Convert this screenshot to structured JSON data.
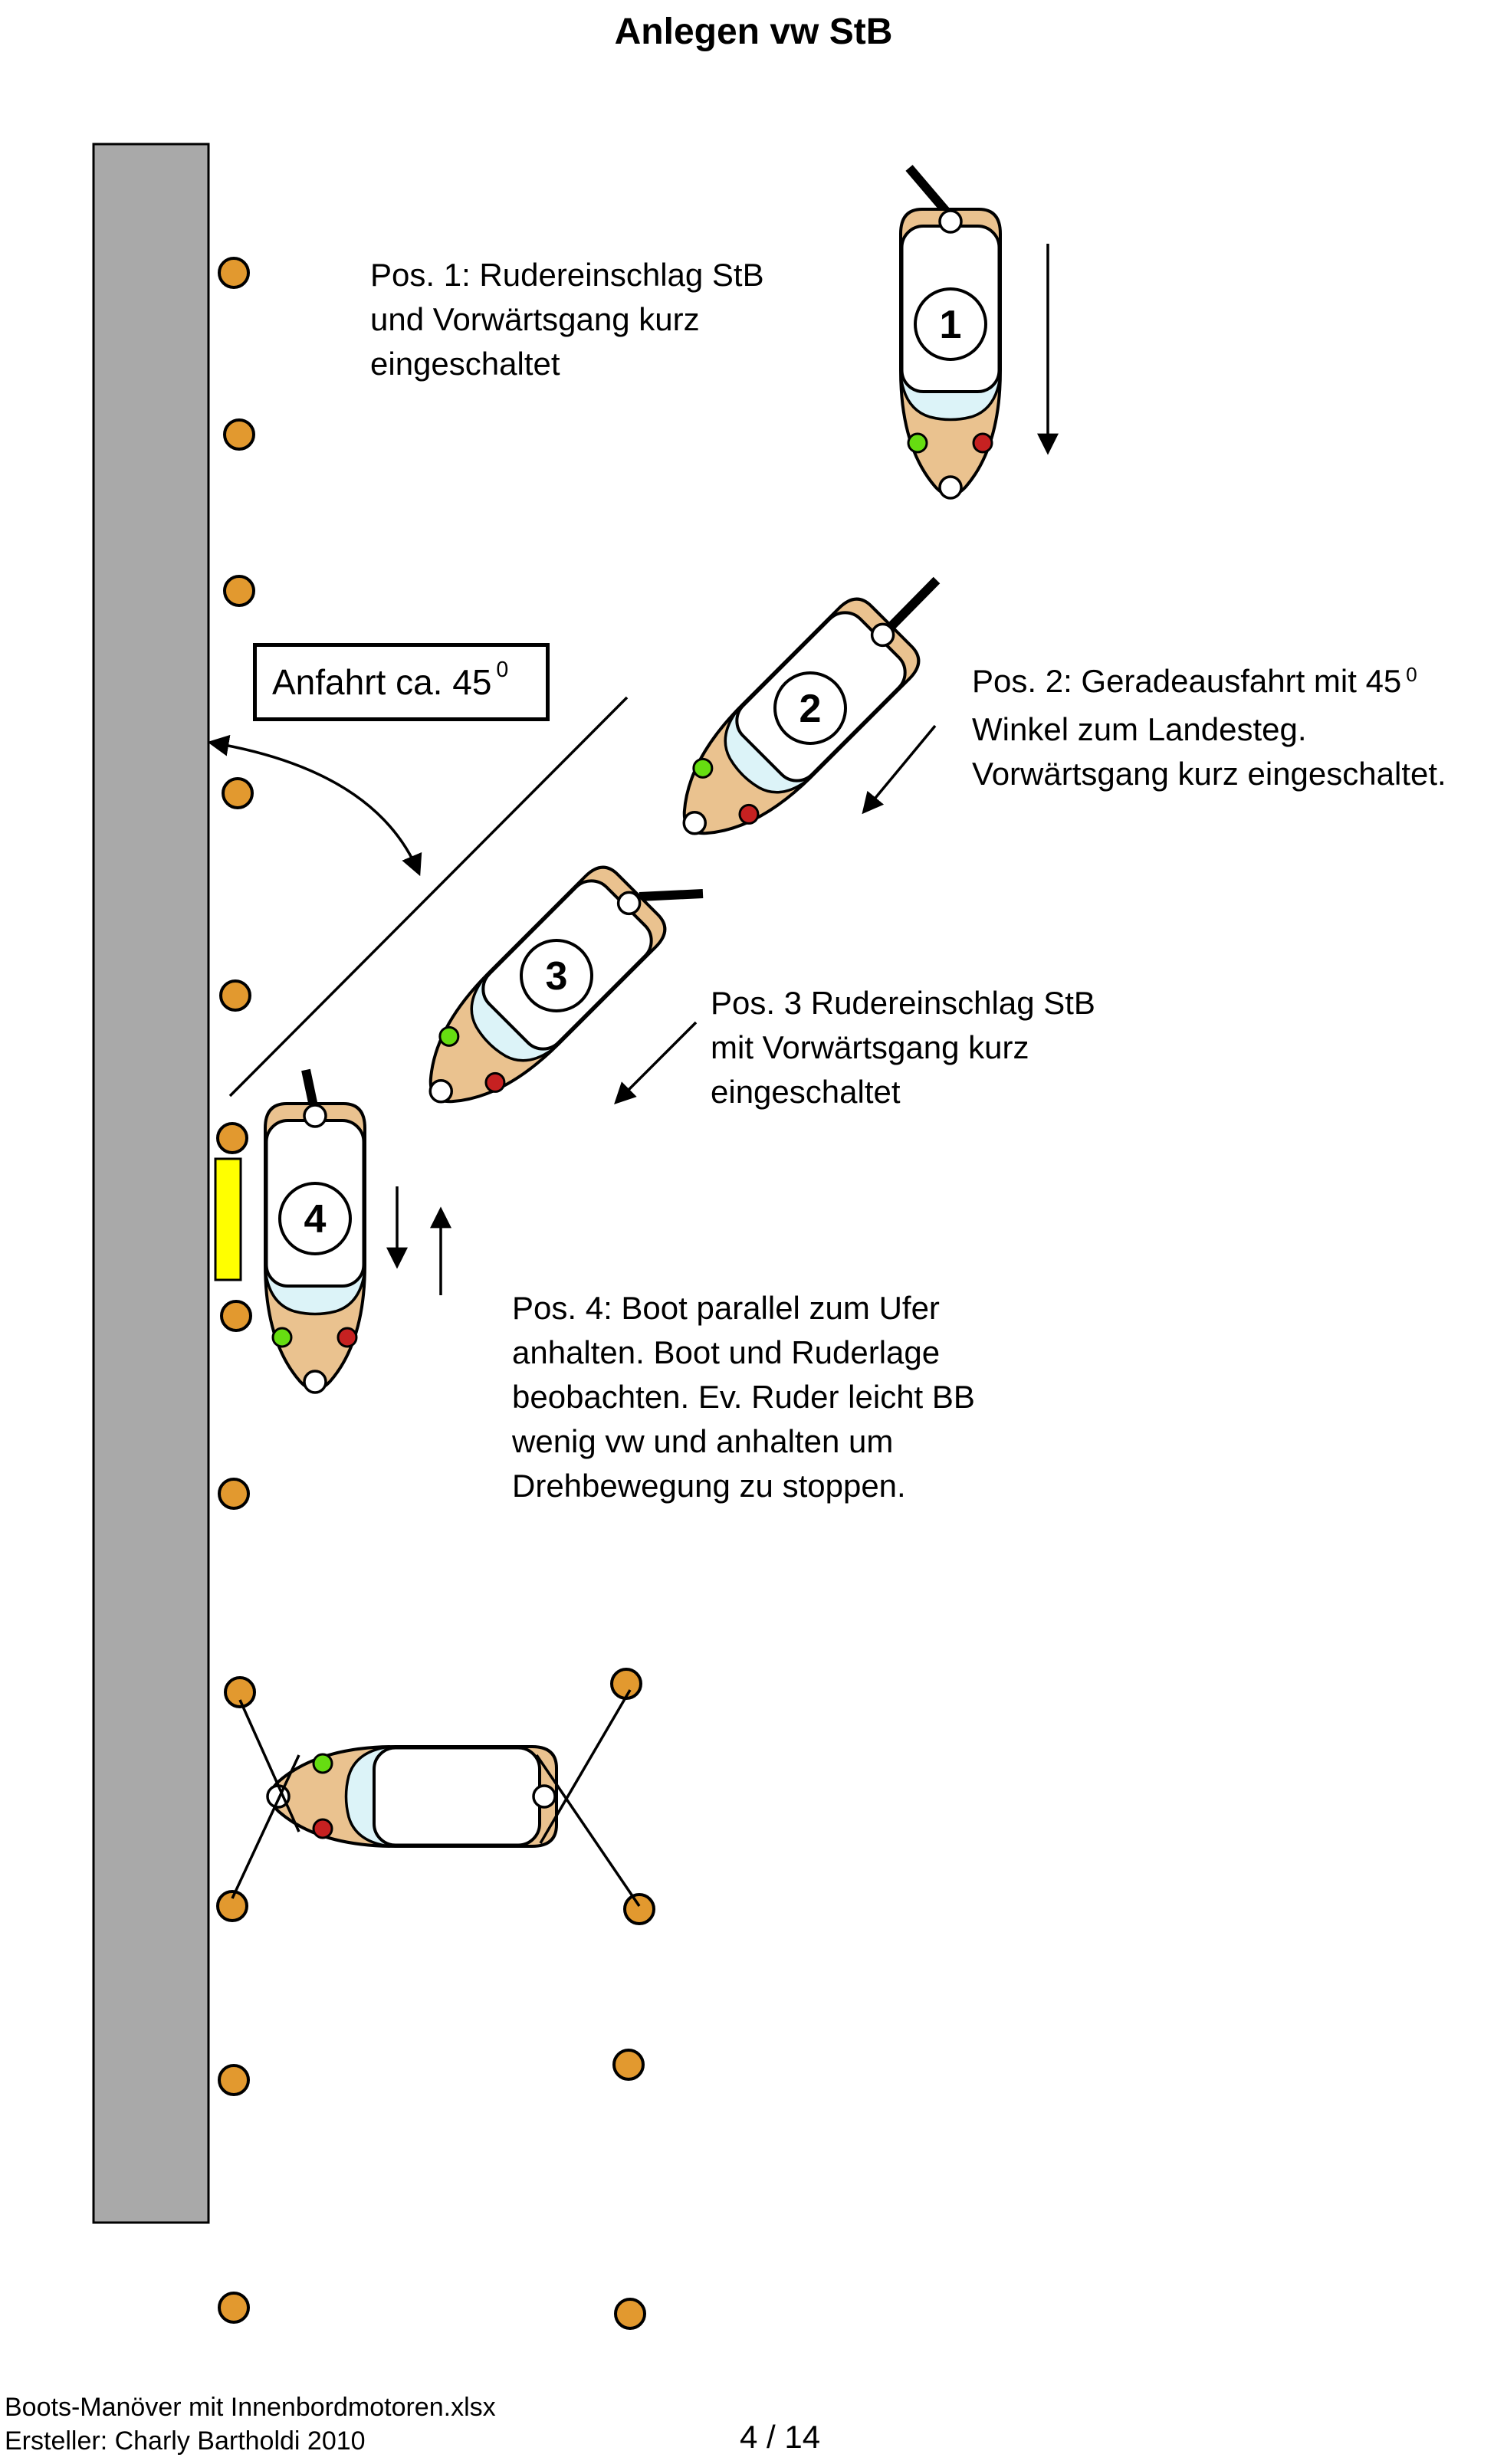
{
  "title": "Anlegen vw StB",
  "annotations": {
    "pos1": {
      "line1": "Pos. 1: Rudereinschlag StB",
      "line2": "und Vorwärtsgang kurz",
      "line3": "eingeschaltet"
    },
    "pos2": {
      "line1_prefix": "Pos. 2: Geradeausfahrt mit 45",
      "line1_sup": "0",
      "line2": "Winkel zum Landesteg.",
      "line3": "Vorwärtsgang kurz eingeschaltet."
    },
    "pos3": {
      "line1": "Pos. 3 Rudereinschlag StB",
      "line2": "mit Vorwärtsgang kurz",
      "line3": "eingeschaltet"
    },
    "pos4": {
      "line1": "Pos. 4: Boot parallel zum Ufer",
      "line2": "anhalten. Boot und Ruderlage",
      "line3": "beobachten. Ev. Ruder leicht BB",
      "line4": "wenig vw und anhalten um",
      "line5": "Drehbewegung zu stoppen."
    },
    "anfahrt": {
      "label": "Anfahrt ca. 45",
      "sup": "0"
    }
  },
  "boats": {
    "boat1": {
      "number": "1"
    },
    "boat2": {
      "number": "2"
    },
    "boat3": {
      "number": "3"
    },
    "boat4": {
      "number": "4"
    }
  },
  "footer": {
    "filename": "Boots-Manöver mit Innenbordmotoren.xlsx",
    "creator": "Ersteller: Charly Bartholdi 2010",
    "page": "4 / 14"
  },
  "colors": {
    "dock": "#A9A9A9",
    "post": "#E2992F",
    "fender": "#FFFF00",
    "hull": "#EAC28F",
    "windshield": "#DCF3F8",
    "navgreen": "#66DD11",
    "navred": "#C62121"
  }
}
